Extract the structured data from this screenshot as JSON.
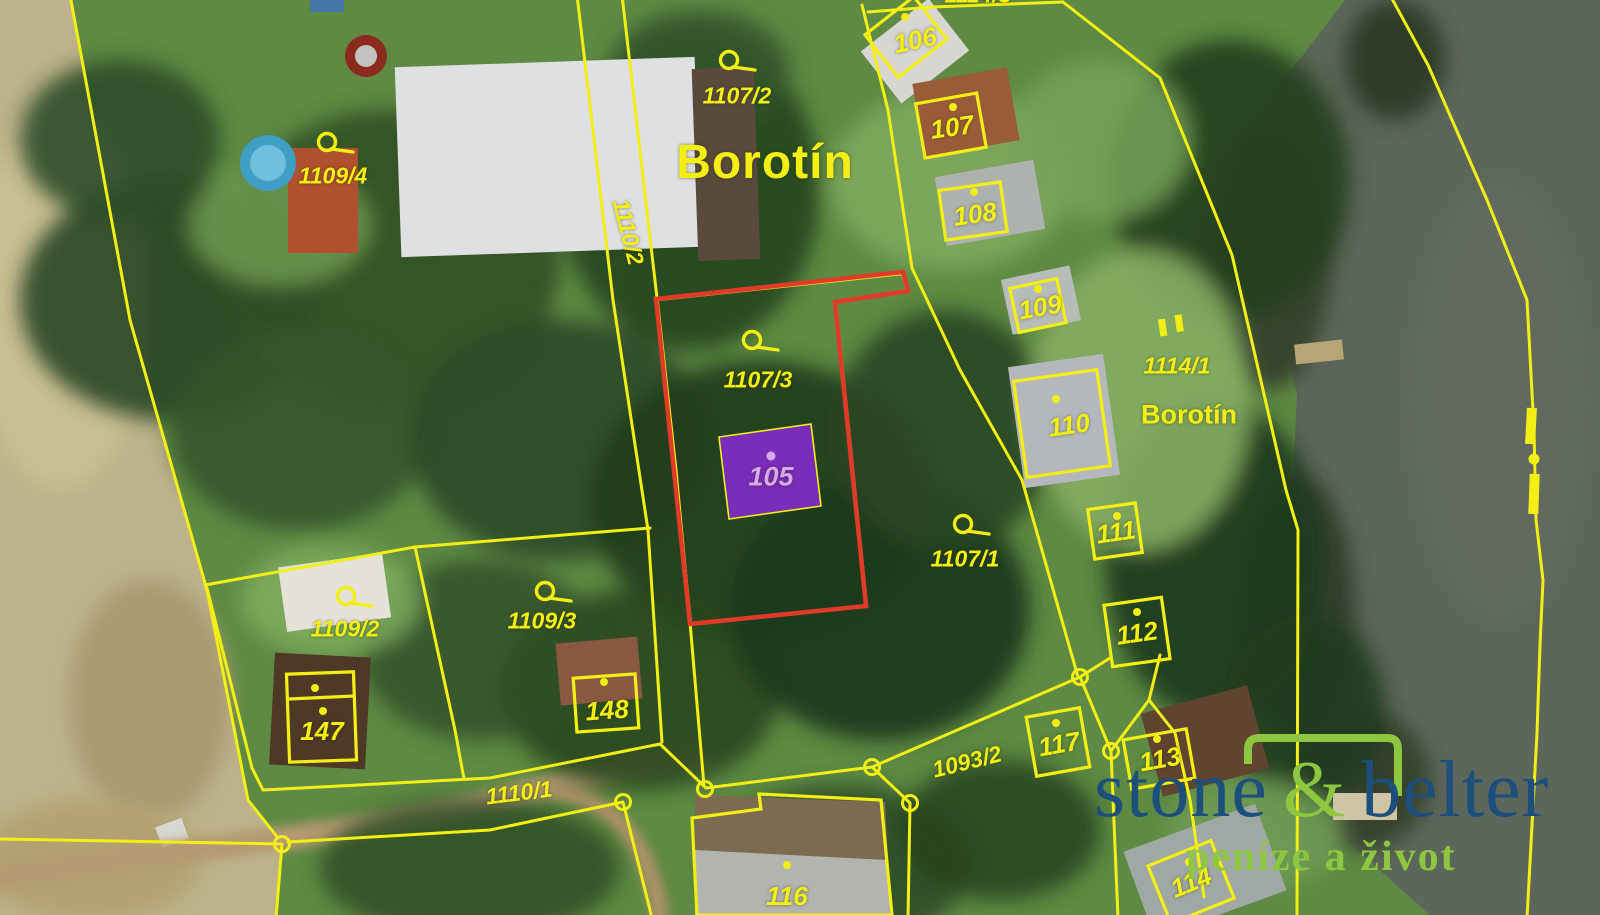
{
  "map": {
    "region_labels": {
      "borotin_large": "Borotín",
      "borotin_small": "Borotín",
      "clipped_top": "1114/3"
    },
    "parcel_numbers": {
      "p1109_4": "1109/4",
      "p1107_2": "1107/2",
      "p1110_2": "1110/2",
      "p1107_3": "1107/3",
      "p1107_1": "1107/1",
      "p1114_1": "1114/1",
      "p1109_2": "1109/2",
      "p1109_3": "1109/3",
      "p1110_1": "1110/1",
      "p1093_2": "1093/2"
    },
    "building_numbers": {
      "b105": "105",
      "b106": "106",
      "b107": "107",
      "b108": "108",
      "b109": "109",
      "b110": "110",
      "b111": "111",
      "b112": "112",
      "b113": "113",
      "b114": "114",
      "b116": "116",
      "b117": "117",
      "b147": "147",
      "b148": "148"
    }
  },
  "watermark": {
    "brand_first": "stone",
    "brand_ampersand": "&",
    "brand_second": "belter",
    "tagline": "peníze a život"
  },
  "colors": {
    "boundary_yellow": "#f3ef15",
    "highlight_red": "#e23a28",
    "highlight_building_purple": "#7a2cba",
    "building_label_lavender": "#d7a9ea",
    "logo_blue": "#1d4f7c",
    "logo_green": "#8dc63f"
  }
}
